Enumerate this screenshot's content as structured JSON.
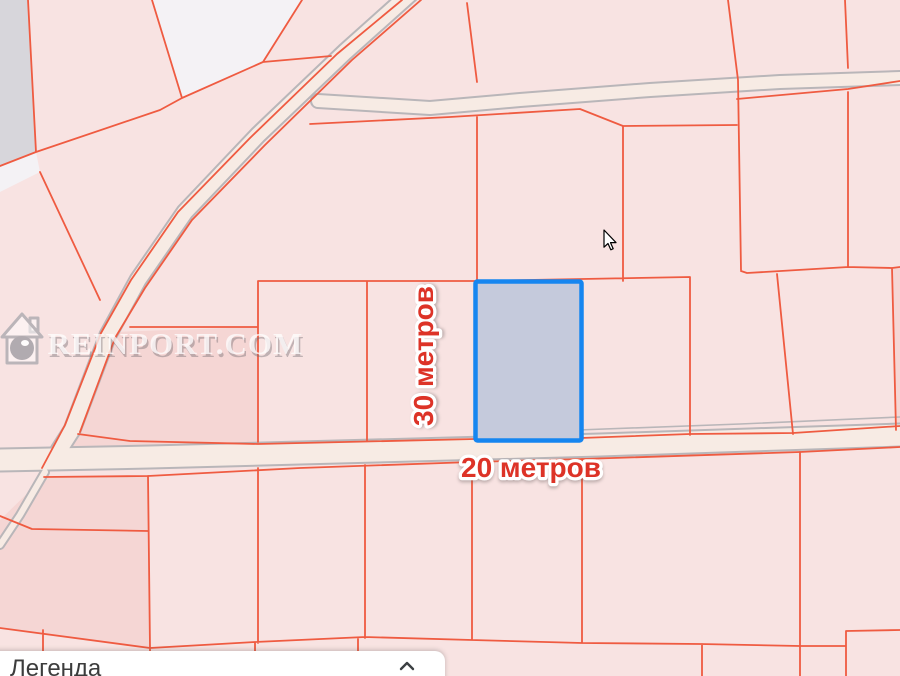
{
  "map": {
    "watermark": {
      "text": "REINPORT.COM",
      "icon": "house-icon"
    },
    "dimension_labels": {
      "width": "20 метров",
      "height": "30 метров"
    },
    "selected_parcel": {
      "fill": "#c5cadc",
      "stroke": "#1686f0"
    },
    "colors": {
      "parcel_fill": "#f8e3e2",
      "parcel_fill_dark": "#f5d6d4",
      "parcel_fill_gray": "#d7d6db",
      "parcel_fill_white": "#f4f2f5",
      "parcel_line": "#ef5b41",
      "road_fill": "#f7ebe4",
      "road_casing": "#b9b6b9",
      "label_color": "#dd3327",
      "watermark_color": "#ffffff"
    }
  },
  "legend_panel": {
    "title": "Легенда",
    "collapse_icon": "chevron-up"
  },
  "cursor": {
    "type": "arrow"
  }
}
